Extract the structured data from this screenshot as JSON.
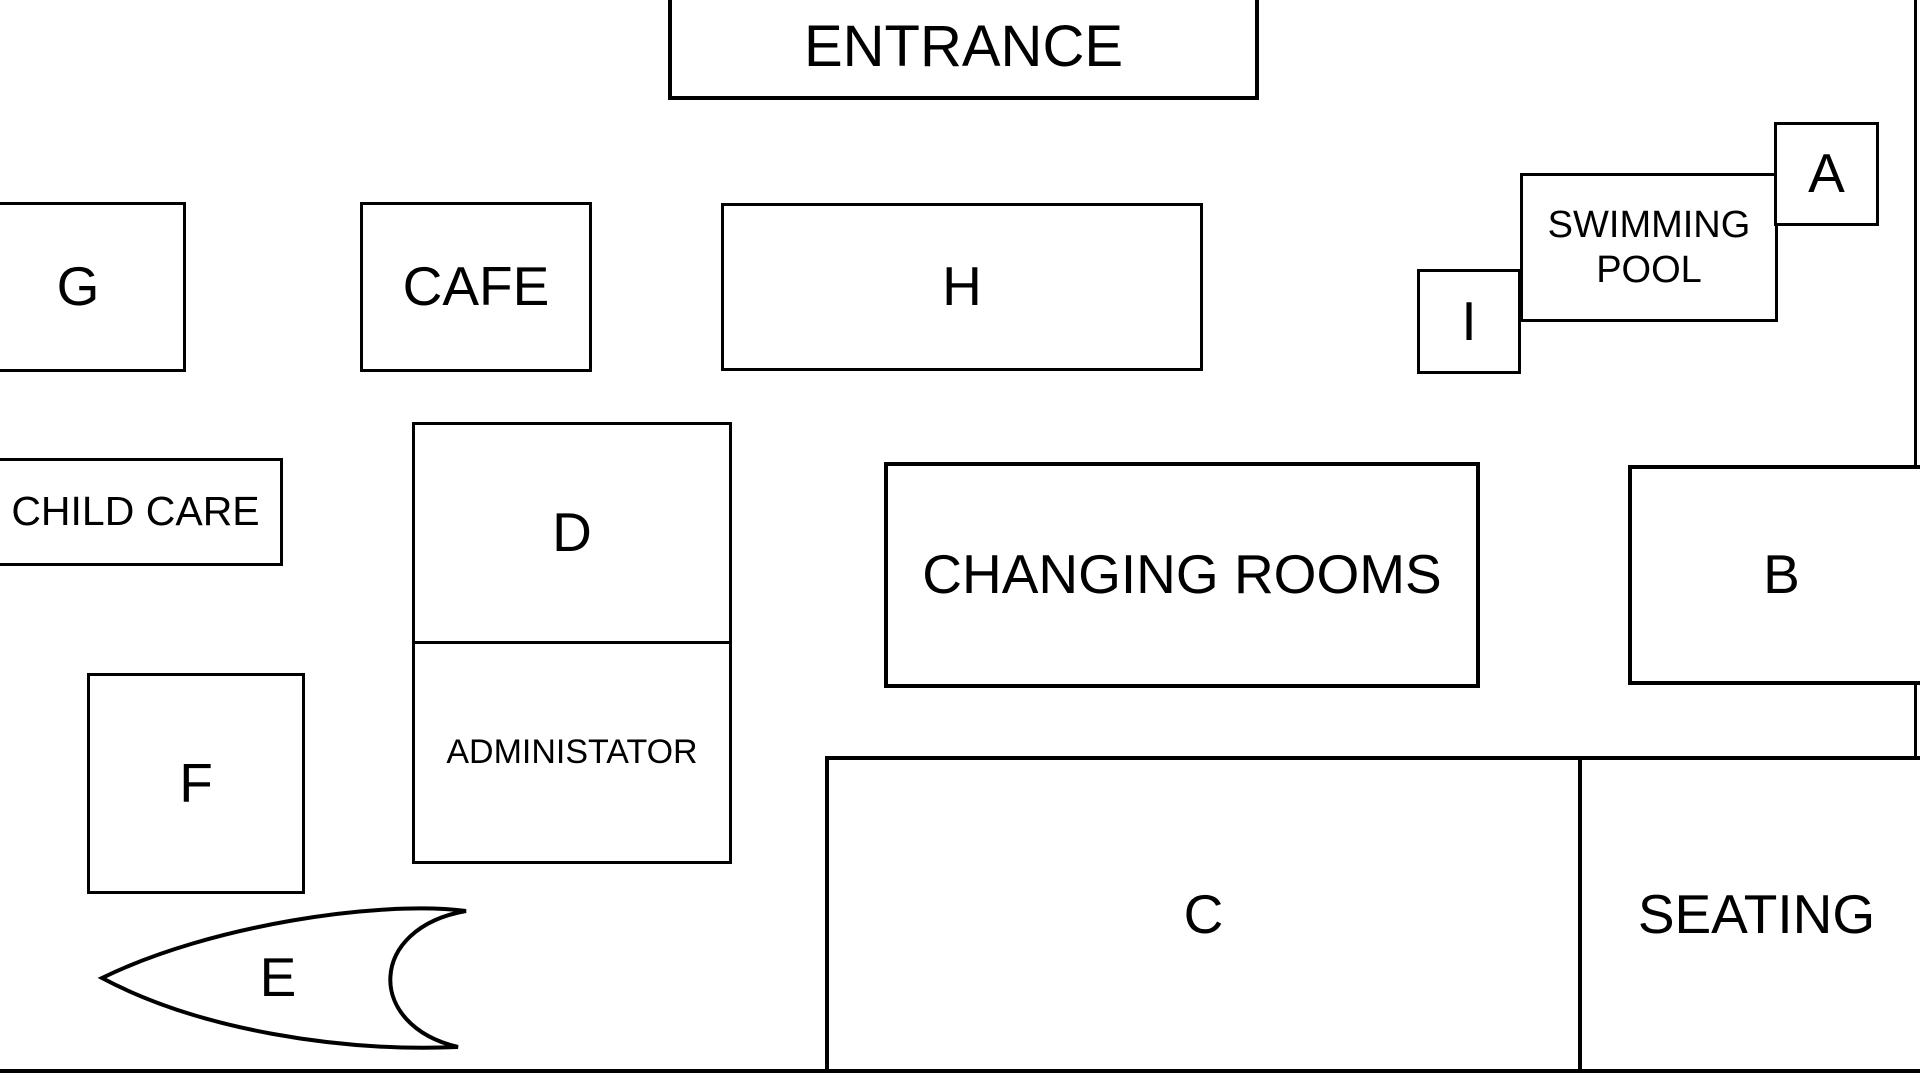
{
  "diagram": {
    "type": "floor-plan",
    "colors": {
      "line": "#000000",
      "background": "#ffffff",
      "text": "#000000"
    }
  },
  "rooms": {
    "entrance": {
      "label": "ENTRANCE"
    },
    "g": {
      "label": "G"
    },
    "cafe": {
      "label": "CAFE"
    },
    "h": {
      "label": "H"
    },
    "swimming_pool": {
      "label": "SWIMMING POOL"
    },
    "a": {
      "label": "A"
    },
    "i": {
      "label": "I"
    },
    "child_care": {
      "label": "CHILD CARE"
    },
    "d": {
      "label": "D"
    },
    "administator": {
      "label": "ADMINISTATOR"
    },
    "changing_rooms": {
      "label": "CHANGING ROOMS"
    },
    "b": {
      "label": "B"
    },
    "f": {
      "label": "F"
    },
    "e": {
      "label": "E"
    },
    "c": {
      "label": "C"
    },
    "seating": {
      "label": "SEATING"
    }
  }
}
